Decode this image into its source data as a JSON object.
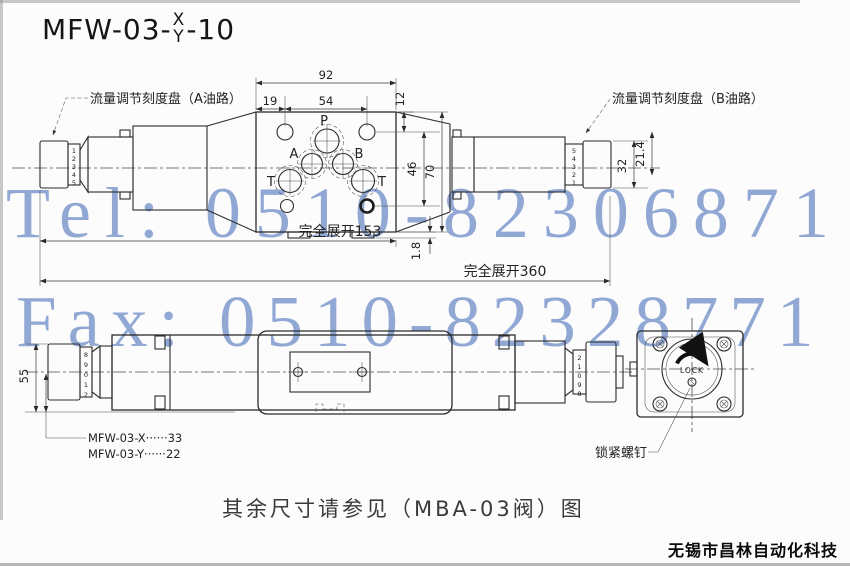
{
  "colors": {
    "line": "#2b2b2b",
    "dim": "#3a3a3a",
    "watermark": "#7f9ace",
    "background": "#fcfcfc"
  },
  "title": {
    "prefix": "MFW-03-",
    "numerator": "X",
    "denominator": "Y",
    "suffix": "-10"
  },
  "watermarks": {
    "tel": "Tel: 0510-82306871",
    "fax": "Fax: 0510-82328771"
  },
  "top_view": {
    "label_a": "流量调节刻度盘（A油路）",
    "label_b": "流量调节刻度盘（B油路）",
    "ports": {
      "p": "P",
      "a": "A",
      "b": "B",
      "t_left": "T",
      "t_right": "T"
    },
    "dims": {
      "w92": "92",
      "w12": "12",
      "w19": "19",
      "w54": "54",
      "h46": "46",
      "h70": "70",
      "h32": "32",
      "h21_4": "21.4",
      "step1_8": "1.8",
      "extend153": "完全展开153",
      "extend360": "完全展开360"
    },
    "left_dial_digits": [
      "1",
      "2",
      "3",
      "4",
      "5"
    ],
    "right_dial_digits": [
      "5",
      "4",
      "3",
      "2",
      "1"
    ]
  },
  "bottom_view": {
    "dims": {
      "h55": "55",
      "variant_x": "MFW-03-X······33",
      "variant_y": "MFW-03-Y······22"
    },
    "left_dial_digits": [
      "8",
      "9",
      "0",
      "1",
      "2"
    ],
    "right_dial_digits": [
      "2",
      "1",
      "0",
      "9",
      "8"
    ],
    "lock_label": "LOCK",
    "lock_screw_label": "锁紧螺钉"
  },
  "footer": {
    "note": "其余尺寸请参见（MBA-03阀）图",
    "company": "无锡市昌林自动化科技"
  }
}
